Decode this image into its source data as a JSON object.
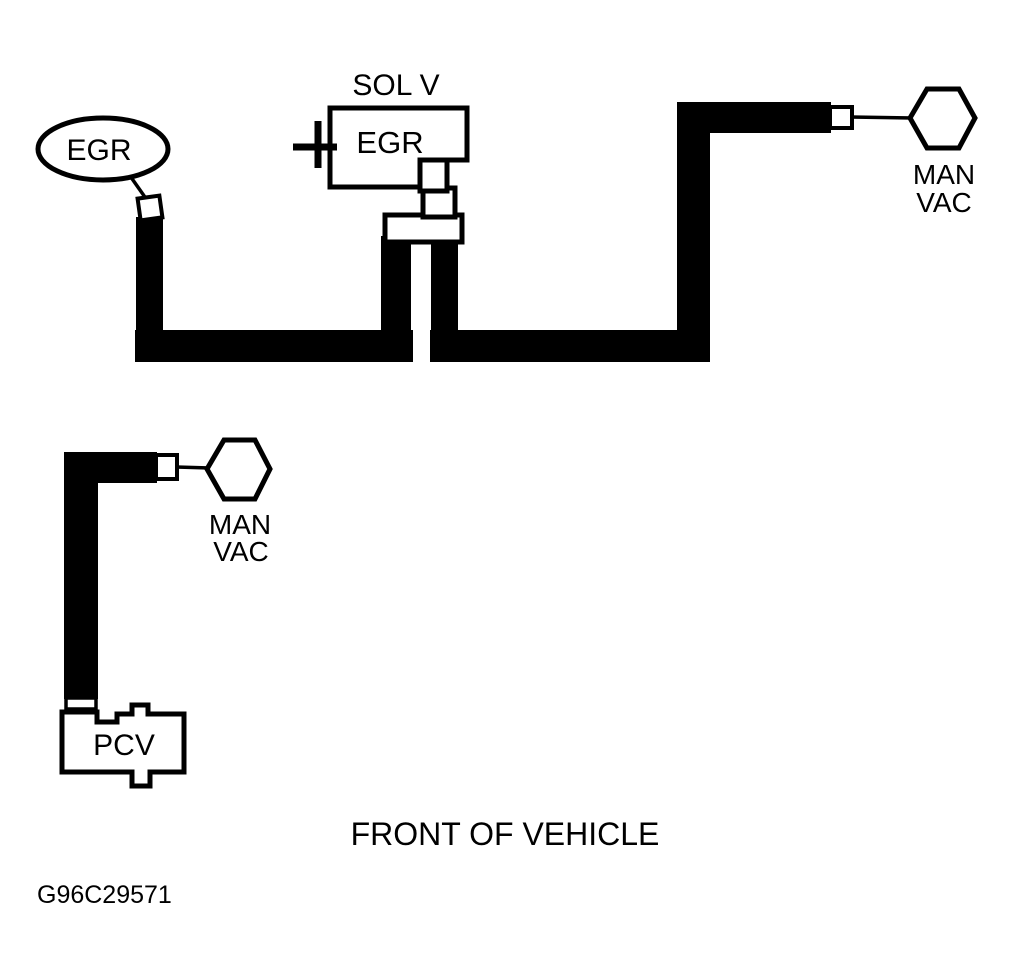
{
  "colors": {
    "ink": "#000000",
    "paper": "#ffffff"
  },
  "egr_valve": {
    "label": "EGR"
  },
  "egr_solenoid": {
    "title": "SOL V",
    "label": "EGR"
  },
  "man_vac_upper": {
    "line1": "MAN",
    "line2": "VAC"
  },
  "man_vac_lower": {
    "line1": "MAN",
    "line2": "VAC"
  },
  "pcv_valve": {
    "label": "PCV"
  },
  "footer": {
    "caption": "FRONT OF VEHICLE",
    "figure_id": "G96C29571"
  }
}
